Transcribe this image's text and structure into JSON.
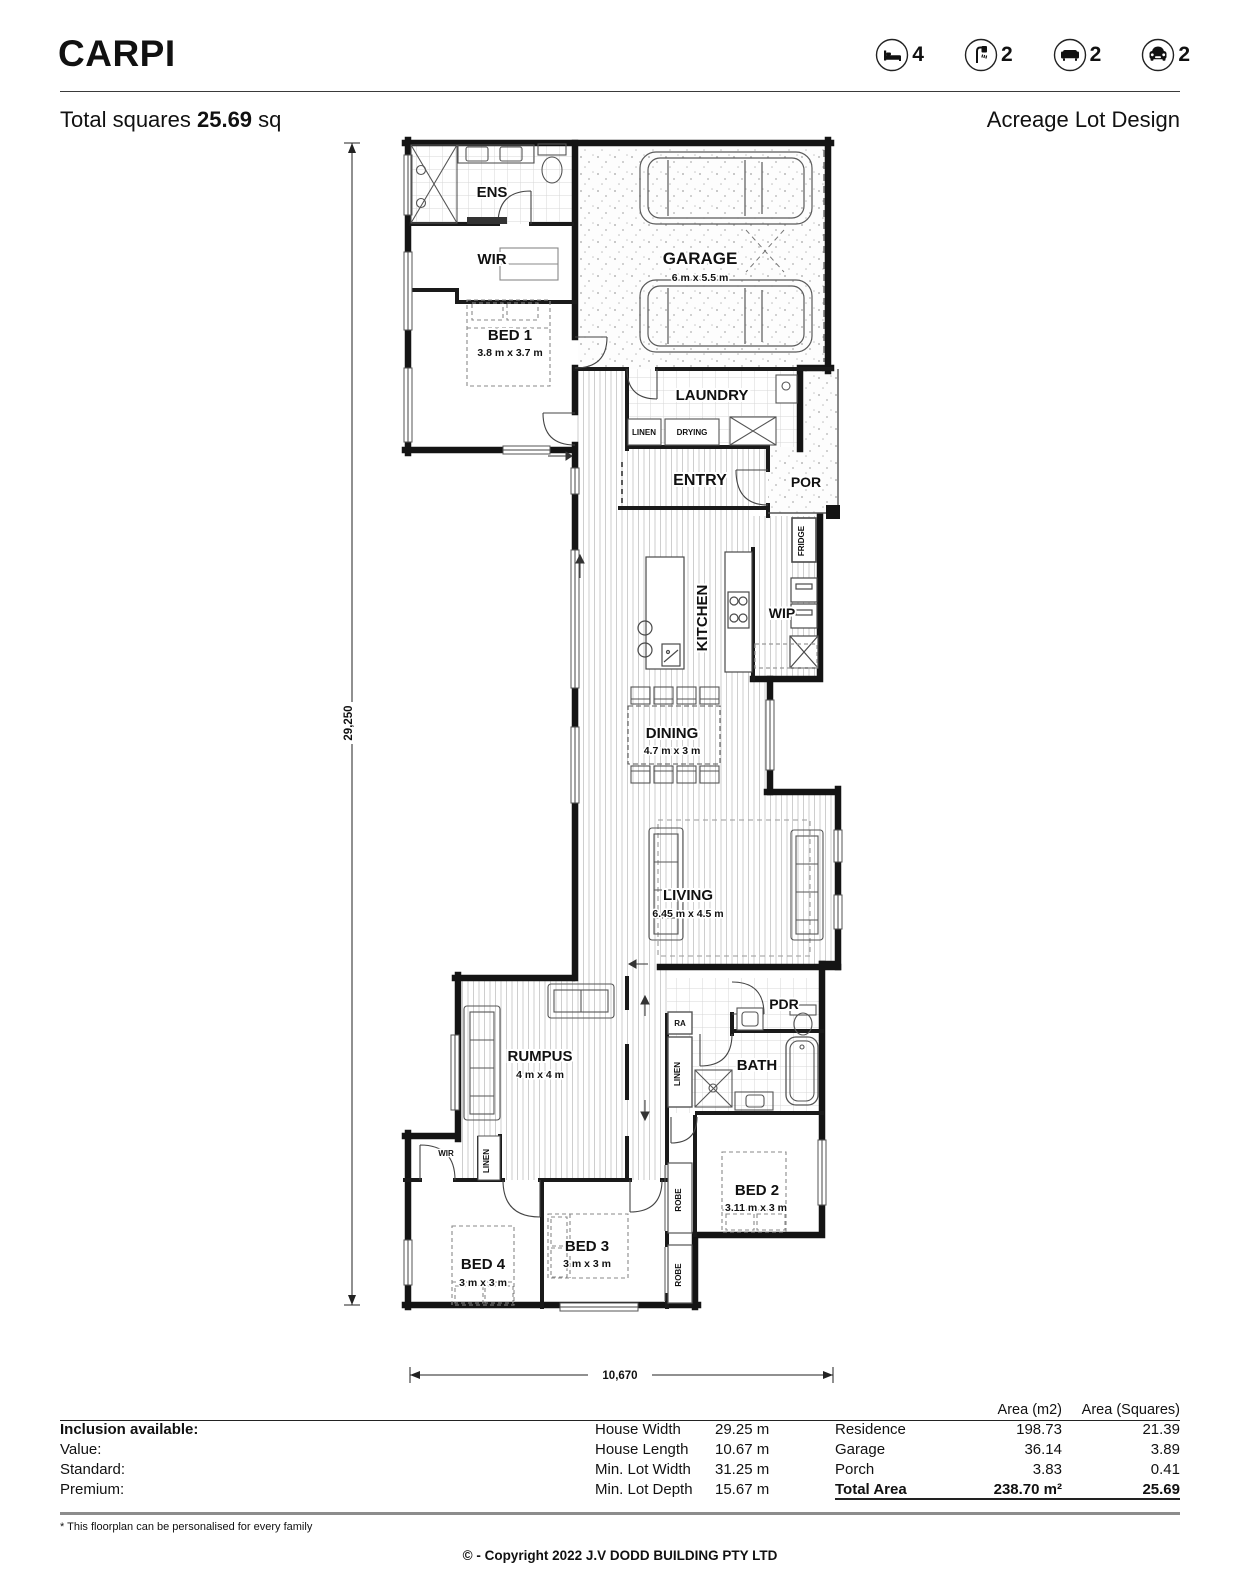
{
  "header": {
    "title": "CARPI",
    "stats": [
      {
        "icon": "bed",
        "count": "4"
      },
      {
        "icon": "shower",
        "count": "2"
      },
      {
        "icon": "sofa",
        "count": "2"
      },
      {
        "icon": "car",
        "count": "2"
      }
    ],
    "total_squares_label": "Total squares",
    "total_squares_value": "25.69",
    "total_squares_unit": "sq",
    "design_type": "Acreage Lot Design"
  },
  "floorplan": {
    "rooms": [
      {
        "name": "ENS"
      },
      {
        "name": "WIR"
      },
      {
        "name": "BED 1",
        "dims": "3.8 m x 3.7 m"
      },
      {
        "name": "GARAGE",
        "dims": "6 m x 5.5 m"
      },
      {
        "name": "LAUNDRY"
      },
      {
        "name": "LINEN"
      },
      {
        "name": "DRYING"
      },
      {
        "name": "ENTRY"
      },
      {
        "name": "POR"
      },
      {
        "name": "FRIDGE"
      },
      {
        "name": "KITCHEN"
      },
      {
        "name": "WIP"
      },
      {
        "name": "DINING",
        "dims": "4.7 m x 3 m"
      },
      {
        "name": "LIVING",
        "dims": "6.45 m x 4.5 m"
      },
      {
        "name": "RUMPUS",
        "dims": "4 m x 4 m"
      },
      {
        "name": "PDR"
      },
      {
        "name": "RA"
      },
      {
        "name": "LINEN"
      },
      {
        "name": "BATH"
      },
      {
        "name": "BED 2",
        "dims": "3.11 m x 3 m"
      },
      {
        "name": "ROBE"
      },
      {
        "name": "ROBE"
      },
      {
        "name": "WIR"
      },
      {
        "name": "LINEN"
      },
      {
        "name": "BED 3",
        "dims": "3 m x 3 m"
      },
      {
        "name": "BED 4",
        "dims": "3 m x 3 m"
      }
    ],
    "dimensions": {
      "overall_depth": "29,250",
      "overall_width": "10,670"
    }
  },
  "inclusions": {
    "rows": [
      "Inclusion available:",
      "Value:",
      "Standard:",
      "Premium:"
    ]
  },
  "lot": {
    "rows": [
      {
        "label": "House Width",
        "value": "29.25 m"
      },
      {
        "label": "House Length",
        "value": "10.67 m"
      },
      {
        "label": "Min. Lot Width",
        "value": "31.25 m"
      },
      {
        "label": "Min. Lot Depth",
        "value": "15.67 m"
      }
    ]
  },
  "areas": {
    "col1": "Area (m2)",
    "col2": "Area (Squares)",
    "rows": [
      {
        "label": "Residence",
        "m2": "198.73",
        "squares": "21.39"
      },
      {
        "label": "Garage",
        "m2": "36.14",
        "squares": "3.89"
      },
      {
        "label": "Porch",
        "m2": "3.83",
        "squares": "0.41"
      },
      {
        "label": "Total Area",
        "m2": "238.70 m²",
        "squares": "25.69"
      }
    ]
  },
  "footer": {
    "note": "* This floorplan can be personalised for every family",
    "copyright": "© - Copyright 2022 J.V DODD BUILDING PTY LTD"
  }
}
